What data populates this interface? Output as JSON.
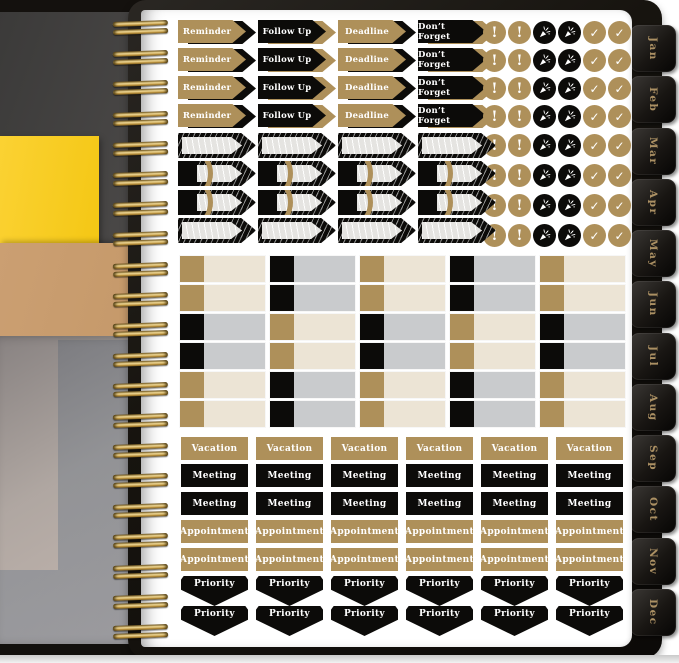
{
  "colors": {
    "tan": "#ae905a",
    "black_sticker": "#0c0b09",
    "cream": "#ece4d5",
    "gray": "#c9cbcd",
    "gold_wire": "#caa24b",
    "tab_text": "#ab9063",
    "cover": "#17140f",
    "page": "#ffffff",
    "desk": "#3b3a39",
    "yellow_paper": "#fbd233",
    "kraft": "#c69a6b"
  },
  "planner": {
    "months": [
      "Jan",
      "Feb",
      "Mar",
      "Apr",
      "May",
      "Jun",
      "Jul",
      "Aug",
      "Sep",
      "Oct",
      "Nov",
      "Dec"
    ],
    "binding_ring_count": 21
  },
  "icons": {
    "exclamation": "!",
    "check": "✓",
    "party": "party-popper"
  },
  "sticker_sheet": {
    "arrow_rows": 4,
    "arrow_columns": [
      {
        "label": "Reminder",
        "style": "tan"
      },
      {
        "label": "Follow Up",
        "style": "black"
      },
      {
        "label": "Deadline",
        "style": "tan"
      },
      {
        "label": "Don’t Forget",
        "style": "black"
      }
    ],
    "circle_rows": 8,
    "circle_pattern": [
      "exclamation",
      "exclamation",
      "party",
      "party",
      "check",
      "check"
    ],
    "flag_columns": 4,
    "flag_rows": [
      {
        "variant": "plain"
      },
      {
        "variant": "arc"
      },
      {
        "variant": "arc"
      },
      {
        "variant": "plain"
      }
    ],
    "grid": {
      "columns": 5,
      "rows": [
        [
          "tan",
          "black",
          "tan",
          "black",
          "tan"
        ],
        [
          "tan",
          "black",
          "tan",
          "black",
          "tan"
        ],
        [
          "black",
          "tan",
          "black",
          "tan",
          "black"
        ],
        [
          "black",
          "tan",
          "black",
          "tan",
          "black"
        ],
        [
          "tan",
          "black",
          "tan",
          "black",
          "tan"
        ],
        [
          "tan",
          "black",
          "tan",
          "black",
          "tan"
        ]
      ]
    },
    "label_columns": 6,
    "label_rows": [
      {
        "label": "Vacation",
        "style": "tan",
        "shape": "rect"
      },
      {
        "label": "Meeting",
        "style": "black",
        "shape": "rect"
      },
      {
        "label": "Meeting",
        "style": "black",
        "shape": "rect"
      },
      {
        "label": "Appointment",
        "style": "tan",
        "shape": "rect"
      },
      {
        "label": "Appointment",
        "style": "tan",
        "shape": "rect"
      },
      {
        "label": "Priority",
        "style": "black",
        "shape": "pennant"
      },
      {
        "label": "Priority",
        "style": "black",
        "shape": "pennant"
      }
    ]
  }
}
